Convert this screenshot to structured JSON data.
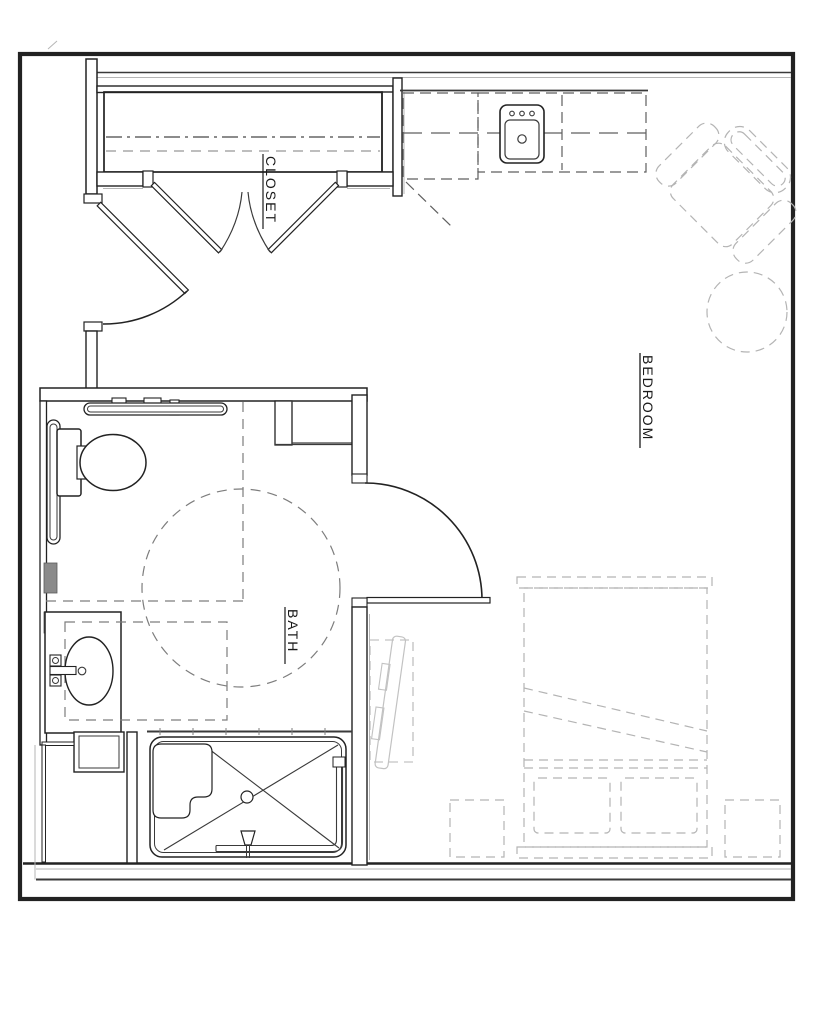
{
  "page": {
    "title": "Accessible bedroom / bath floor plan"
  },
  "colors": {
    "wall": "#222222",
    "line": "#3a3a3a",
    "light": "#b5b5b5",
    "dash": "#5f5f5f",
    "dash2": "#7d7d7d",
    "furniture_dash": "#b4b4b4",
    "tv_line": "#c2c2c2",
    "block_fill": "#8a8a8a",
    "background": "#ffffff",
    "text": "#1a1a1a"
  },
  "rooms": {
    "closet": {
      "label": "CLOSET"
    },
    "bedroom": {
      "label": "BEDROOM"
    },
    "bath": {
      "label": "BATH"
    }
  },
  "fixtures": {
    "kitchen_sink": "kitchen-sink",
    "refrigerator": "refrigerator-dashed",
    "counter": "counter-dashed",
    "closet_rod": "closet-rod-dashdot",
    "closet_shelf": "closet-shelf-dashed",
    "bifold_doors": "closet-bifold-doors",
    "entry_door": "entry-door-swing",
    "bath_door": "bath-door-swing",
    "toilet": "toilet",
    "grab_bars": "grab-bars",
    "vanity_sink": "vanity-sink",
    "shower": "roll-in-shower",
    "turning_circle": "wheelchair-turning-circle-dashed",
    "bed": "bed-dashed",
    "nightstands": "nightstands-dashed",
    "armchair": "armchair-dashed",
    "side_table": "round-table-dashed",
    "tv": "tv-on-dresser"
  }
}
